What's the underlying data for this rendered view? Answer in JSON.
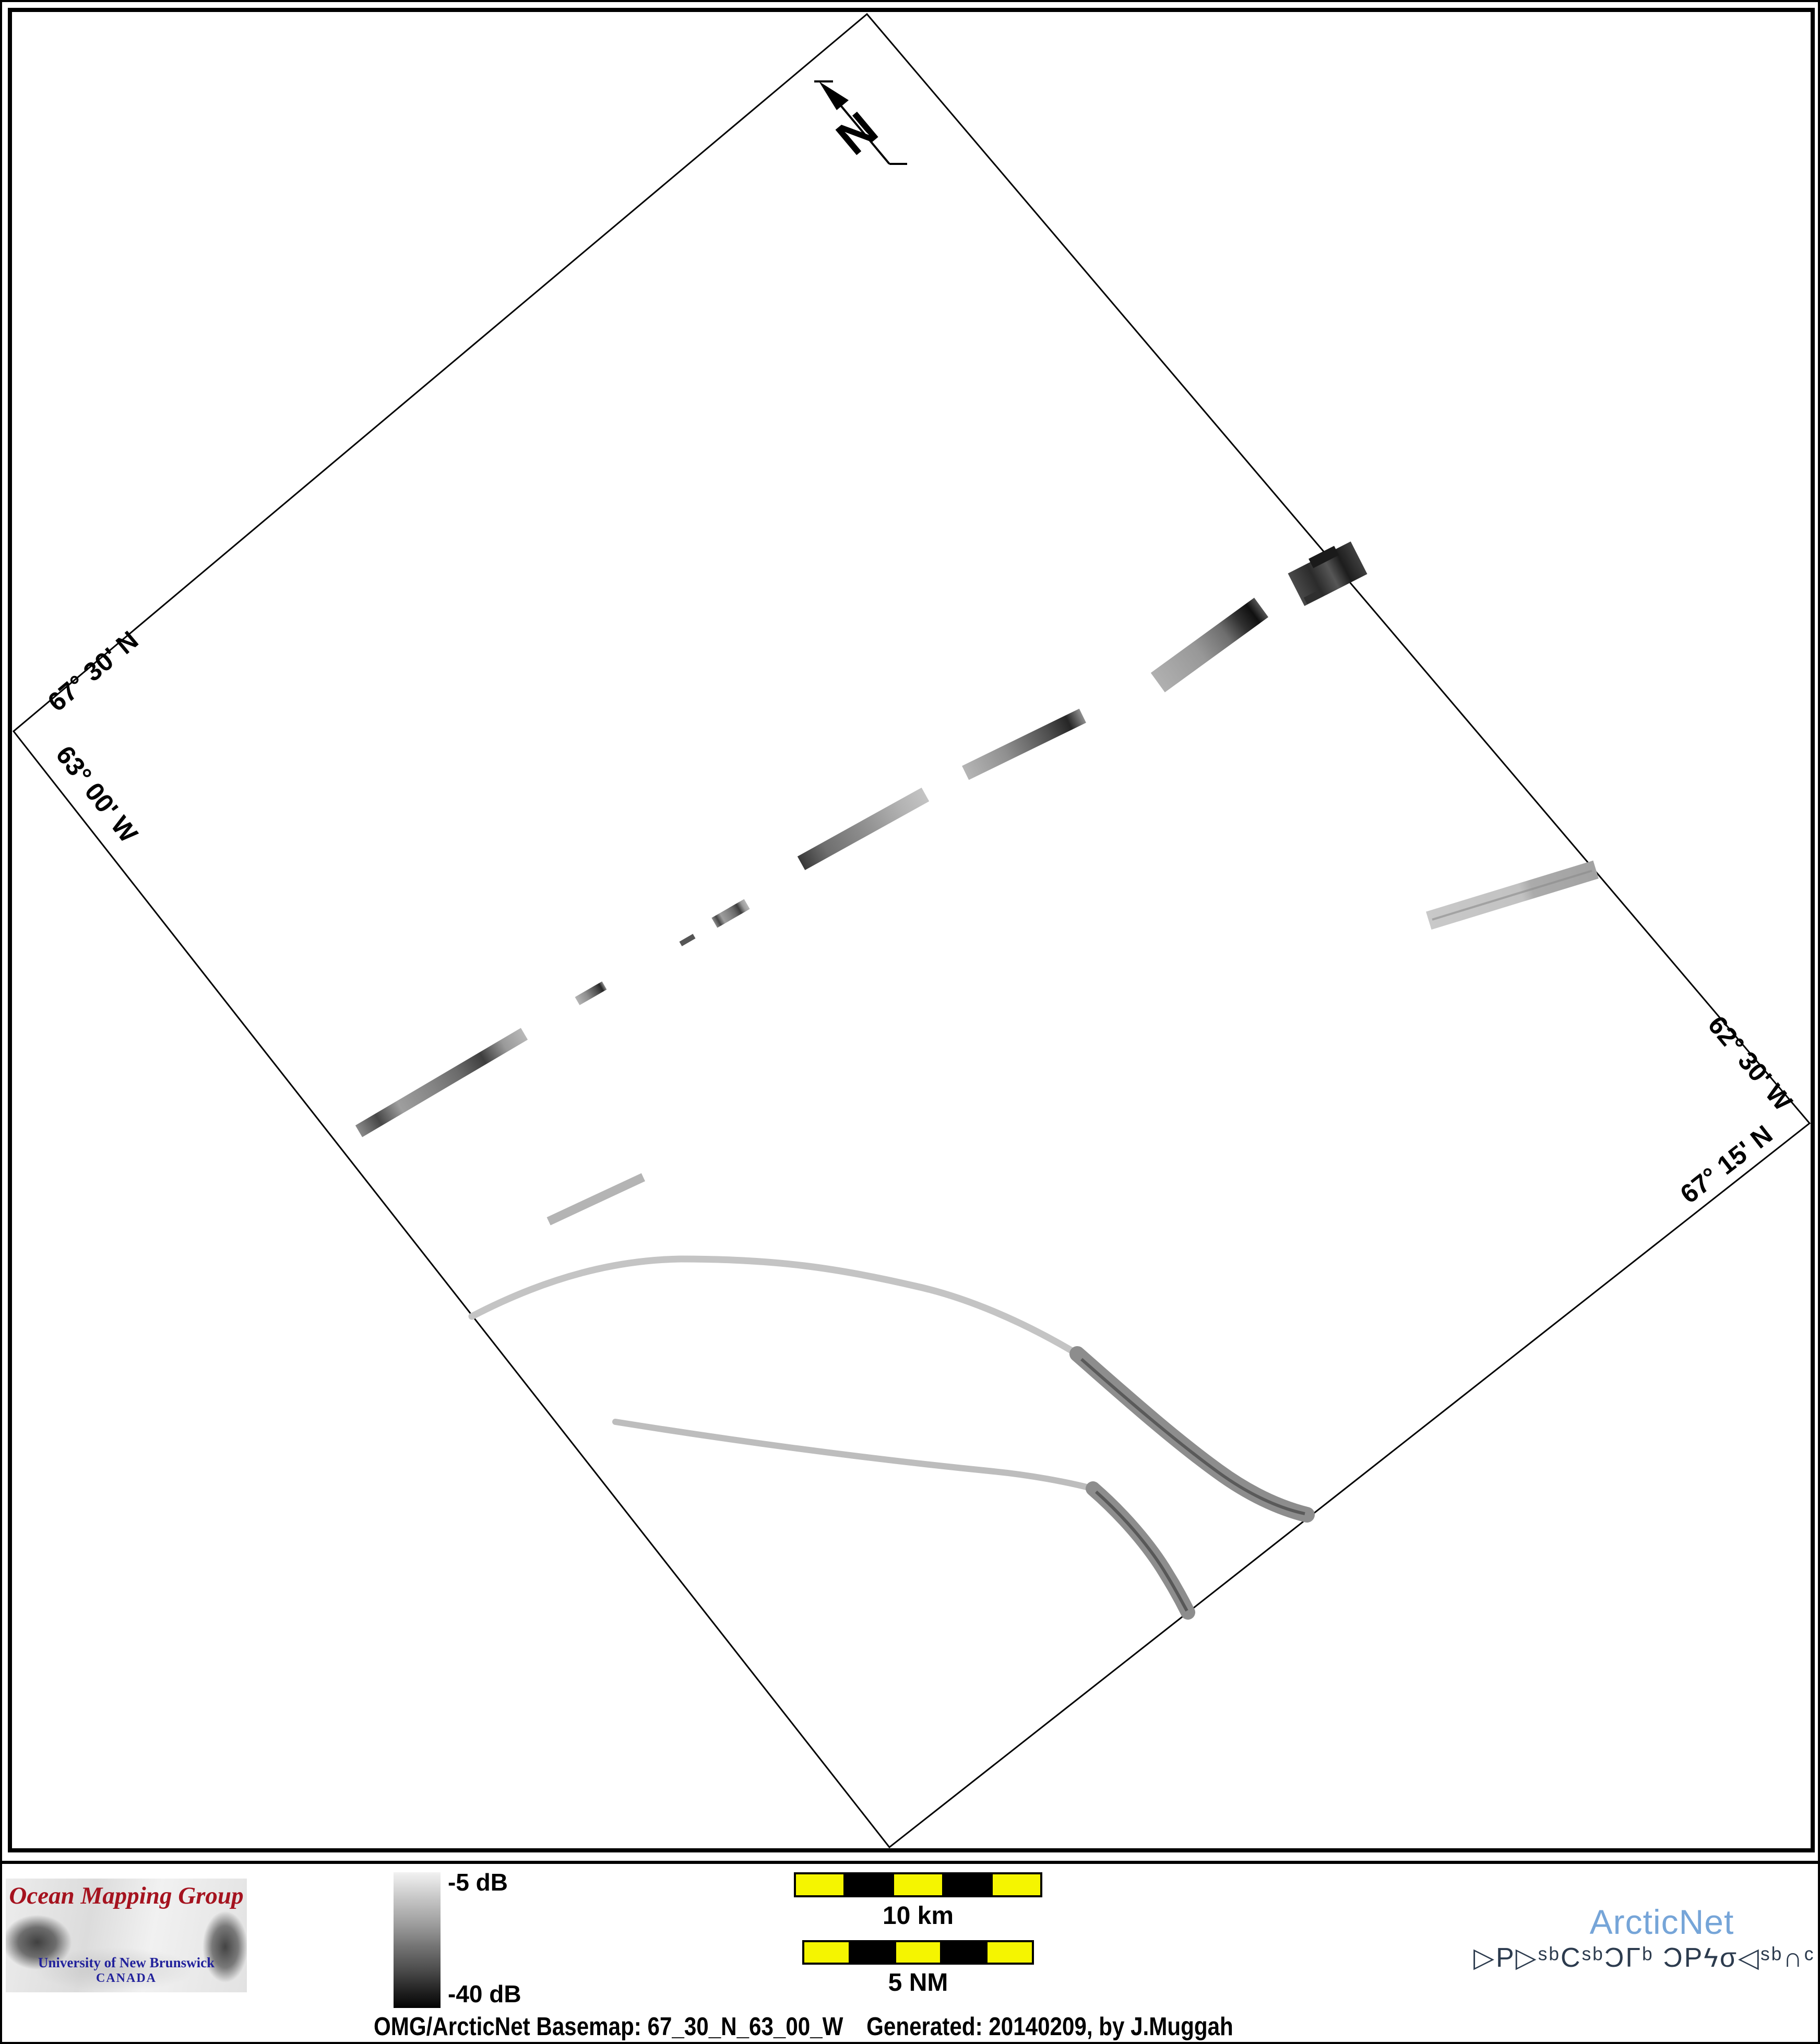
{
  "map": {
    "edge_labels": {
      "top_left": "67° 30' N",
      "bottom_left": "63° 00' W",
      "top_right": "62° 30' W",
      "bottom_right": "67° 15' N"
    },
    "north_label": "N"
  },
  "legend": {
    "colorbar_top_label": "-5 dB",
    "colorbar_bottom_label": "-40 dB"
  },
  "scalebars": {
    "km": {
      "label": "10 km"
    },
    "nm": {
      "label": "5 NM"
    }
  },
  "footer": {
    "caption_left": "OMG/ArcticNet Basemap: 67_30_N_63_00_W",
    "caption_right": "Generated: 20140209, by J.Muggah"
  },
  "logos": {
    "omg": {
      "title": "Ocean Mapping Group",
      "subtitle": "University of New Brunswick",
      "country": "CANADA"
    },
    "arcticnet": {
      "name": "ArcticNet",
      "inuktitut": "ᐅᑭᐅᖅᑕᖅᑐᒥᒃ ᑐᑭᓯᓂᐊᖅᑏᑦ",
      "inuktitut_display": "▷P▷ˢᵇCˢᵇƆΓᵇ ƆPϟσ◁ˢᵇ∩ᶜ"
    }
  },
  "colors": {
    "scalebar_yellow": "#f5f500",
    "omg_red": "#a5131f",
    "unb_blue": "#22229b",
    "arcticnet_blue": "#76a5d8",
    "inuktitut_navy": "#2c3b4e",
    "frame_black": "#000000"
  }
}
